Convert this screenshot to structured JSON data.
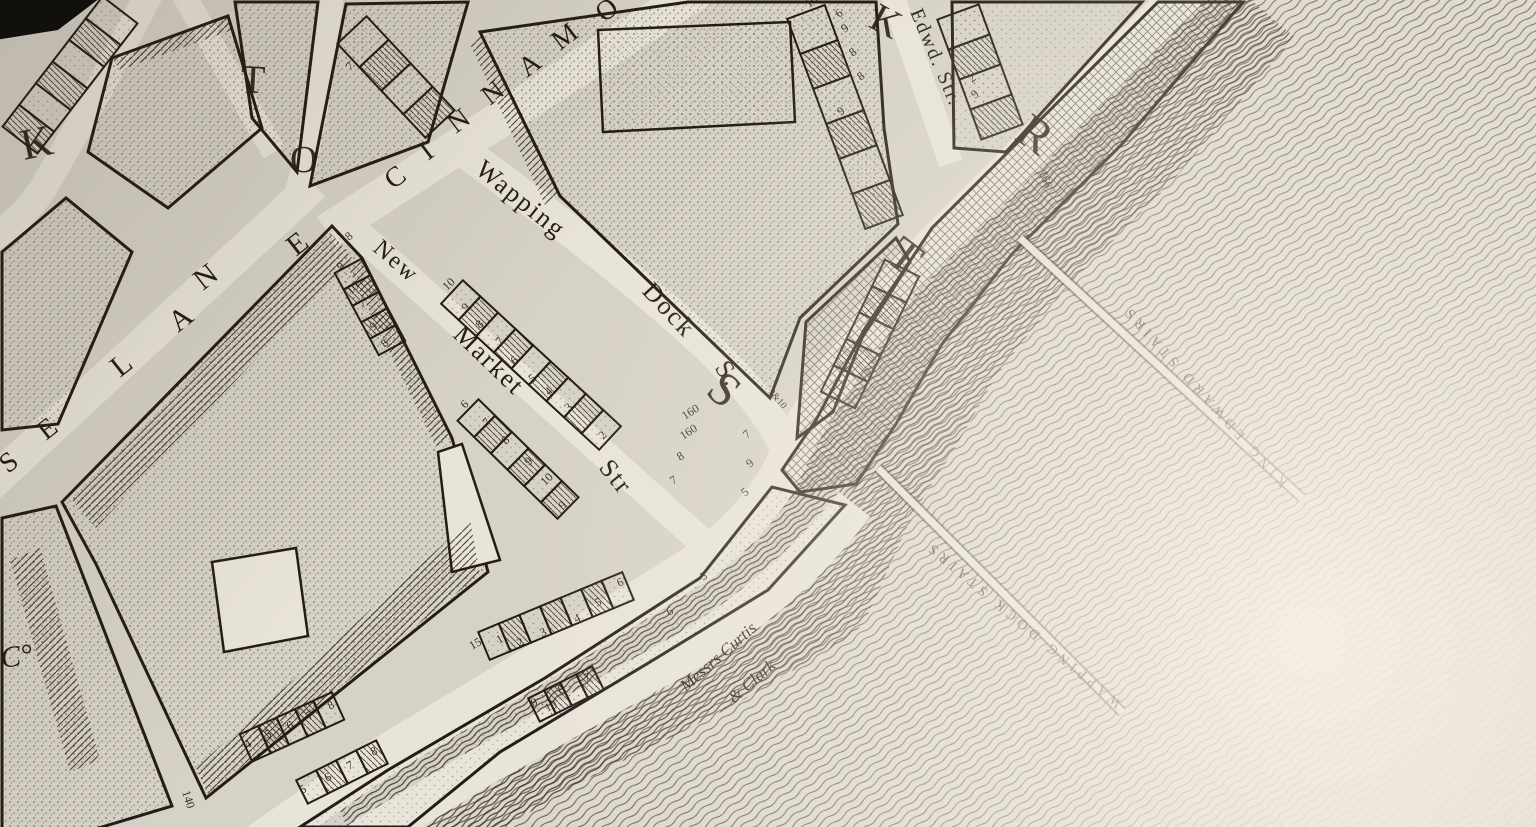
{
  "map_title": "Engraved river-front street map (Wapping, London)",
  "palette": {
    "paper": "#d7d2c8",
    "paper_light": "#e9e4da",
    "ink": "#241d15",
    "water_line": "#3f362c",
    "black_corner": "#12100d",
    "light_corner": "#f4eee5"
  },
  "labels": [
    {
      "name": "cinnamon-street-letter",
      "text": "C",
      "x": 393,
      "y": 190,
      "r": -37,
      "s": 28,
      "cls": "street-name"
    },
    {
      "name": "cinnamon-street-letter",
      "text": "I",
      "x": 428,
      "y": 161,
      "r": -37,
      "s": 28,
      "cls": "street-name"
    },
    {
      "name": "cinnamon-street-letter",
      "text": "N",
      "x": 456,
      "y": 134,
      "r": -37,
      "s": 28,
      "cls": "street-name"
    },
    {
      "name": "cinnamon-street-letter",
      "text": "N",
      "x": 490,
      "y": 106,
      "r": -37,
      "s": 28,
      "cls": "street-name"
    },
    {
      "name": "cinnamon-street-letter",
      "text": "A",
      "x": 527,
      "y": 78,
      "r": -37,
      "s": 28,
      "cls": "street-name"
    },
    {
      "name": "cinnamon-street-letter",
      "text": "M",
      "x": 560,
      "y": 51,
      "r": -37,
      "s": 28,
      "cls": "street-name"
    },
    {
      "name": "cinnamon-street-letter",
      "text": "O",
      "x": 604,
      "y": 23,
      "r": -37,
      "s": 28,
      "cls": "street-name"
    },
    {
      "name": "wapping-dock-street-name",
      "text": "Wapping",
      "x": 474,
      "y": 172,
      "r": 39,
      "s": 26,
      "cls": "street-name"
    },
    {
      "name": "wapping-dock-street-name",
      "text": "Dock",
      "x": 641,
      "y": 292,
      "r": 47,
      "s": 26,
      "cls": "street-name"
    },
    {
      "name": "wapping-dock-street-name",
      "text": "S.",
      "x": 714,
      "y": 368,
      "r": 55,
      "s": 26,
      "cls": "street-name"
    },
    {
      "name": "new-market-street-name",
      "text": "New",
      "x": 372,
      "y": 250,
      "r": 41,
      "s": 24,
      "cls": "street-name"
    },
    {
      "name": "new-market-street-name",
      "text": "Market",
      "x": 452,
      "y": 336,
      "r": 44,
      "s": 26,
      "cls": "street-name"
    },
    {
      "name": "new-market-street-name",
      "text": "Str",
      "x": 598,
      "y": 468,
      "r": 51,
      "s": 26,
      "cls": "street-name"
    },
    {
      "name": "lane-letter",
      "text": "S",
      "x": 8,
      "y": 474,
      "r": -38,
      "s": 28,
      "cls": "street-name"
    },
    {
      "name": "lane-letter",
      "text": "E",
      "x": 46,
      "y": 441,
      "r": -38,
      "s": 28,
      "cls": "street-name"
    },
    {
      "name": "lane-letter",
      "text": "L",
      "x": 120,
      "y": 378,
      "r": -38,
      "s": 30,
      "cls": "street-name"
    },
    {
      "name": "lane-letter",
      "text": "A",
      "x": 178,
      "y": 333,
      "r": -38,
      "s": 30,
      "cls": "street-name"
    },
    {
      "name": "lane-letter",
      "text": "N",
      "x": 203,
      "y": 291,
      "r": -38,
      "s": 30,
      "cls": "street-name"
    },
    {
      "name": "lane-letter",
      "text": "E",
      "x": 296,
      "y": 257,
      "r": -38,
      "s": 30,
      "cls": "street-name"
    },
    {
      "name": "edward-street-name",
      "text": "Edwd. Str.",
      "x": 910,
      "y": 12,
      "r": 67,
      "s": 20,
      "cls": "street-name"
    },
    {
      "name": "big-street-letter",
      "text": "K",
      "x": 24,
      "y": 160,
      "r": -12,
      "s": 44,
      "cls": "big-letter"
    },
    {
      "name": "big-street-letter",
      "text": "T",
      "x": 240,
      "y": 92,
      "r": 3,
      "s": 40,
      "cls": "big-letter"
    },
    {
      "name": "big-street-letter",
      "text": "O",
      "x": 290,
      "y": 172,
      "r": 0,
      "s": 38,
      "cls": "big-letter"
    },
    {
      "name": "big-street-letter",
      "text": "K",
      "x": 867,
      "y": 26,
      "r": 28,
      "s": 40,
      "cls": "big-letter"
    },
    {
      "name": "big-street-letter",
      "text": "S",
      "x": 704,
      "y": 393,
      "r": 40,
      "s": 48,
      "cls": "big-letter"
    },
    {
      "name": "big-street-letter",
      "text": "T",
      "x": 884,
      "y": 260,
      "r": 37,
      "s": 48,
      "cls": "big-letter"
    },
    {
      "name": "big-street-letter",
      "text": "R",
      "x": 1013,
      "y": 138,
      "r": 35,
      "s": 48,
      "cls": "big-letter"
    },
    {
      "name": "king-edward-stairs-label",
      "text": "KING EDWARD STAIRS",
      "x": 1288,
      "y": 482,
      "r": -132,
      "s": 14,
      "cls": "water-name"
    },
    {
      "name": "wapping-dock-stairs-label",
      "text": "WAPPING DOCK STAIRS",
      "x": 1122,
      "y": 702,
      "r": -140,
      "s": 14,
      "cls": "water-name"
    },
    {
      "name": "wharf-owner-label",
      "text": "Messrs Curtis",
      "x": 686,
      "y": 692,
      "r": -41,
      "s": 17,
      "cls": "cursive"
    },
    {
      "name": "wharf-owner-label",
      "text": "& Clark",
      "x": 734,
      "y": 704,
      "r": -41,
      "s": 17,
      "cls": "cursive"
    },
    {
      "name": "company-abbrev-label",
      "text": "C°",
      "x": 2,
      "y": 668,
      "r": -8,
      "s": 30,
      "cls": "cursive"
    },
    {
      "name": "plot-number",
      "text": "10",
      "x": 447,
      "y": 291,
      "r": -44,
      "s": 12,
      "cls": "plot-num"
    },
    {
      "name": "plot-number",
      "text": "9",
      "x": 466,
      "y": 312,
      "r": -44,
      "s": 12,
      "cls": "plot-num"
    },
    {
      "name": "plot-number",
      "text": "8",
      "x": 480,
      "y": 329,
      "r": -44,
      "s": 12,
      "cls": "plot-num"
    },
    {
      "name": "plot-number",
      "text": "7",
      "x": 500,
      "y": 346,
      "r": -44,
      "s": 12,
      "cls": "plot-num"
    },
    {
      "name": "plot-number",
      "text": "6",
      "x": 515,
      "y": 365,
      "r": -44,
      "s": 12,
      "cls": "plot-num"
    },
    {
      "name": "plot-number",
      "text": "5",
      "x": 533,
      "y": 383,
      "r": -44,
      "s": 12,
      "cls": "plot-num"
    },
    {
      "name": "plot-number",
      "text": "4",
      "x": 549,
      "y": 396,
      "r": -44,
      "s": 12,
      "cls": "plot-num"
    },
    {
      "name": "plot-number",
      "text": "3",
      "x": 569,
      "y": 412,
      "r": -44,
      "s": 12,
      "cls": "plot-num"
    },
    {
      "name": "plot-number",
      "text": "2",
      "x": 603,
      "y": 440,
      "r": -44,
      "s": 12,
      "cls": "plot-num"
    },
    {
      "name": "plot-number",
      "text": "6",
      "x": 465,
      "y": 409,
      "r": -44,
      "s": 12,
      "cls": "plot-num"
    },
    {
      "name": "plot-number",
      "text": "7",
      "x": 487,
      "y": 427,
      "r": -44,
      "s": 12,
      "cls": "plot-num"
    },
    {
      "name": "plot-number",
      "text": "8",
      "x": 506,
      "y": 445,
      "r": -44,
      "s": 12,
      "cls": "plot-num"
    },
    {
      "name": "plot-number",
      "text": "9",
      "x": 529,
      "y": 466,
      "r": -44,
      "s": 12,
      "cls": "plot-num"
    },
    {
      "name": "plot-number",
      "text": "10",
      "x": 545,
      "y": 486,
      "r": -44,
      "s": 12,
      "cls": "plot-num"
    },
    {
      "name": "plot-number",
      "text": "9",
      "x": 563,
      "y": 510,
      "r": -44,
      "s": 12,
      "cls": "plot-num"
    },
    {
      "name": "plot-number",
      "text": "9",
      "x": 341,
      "y": 271,
      "r": -44,
      "s": 12,
      "cls": "plot-num"
    },
    {
      "name": "plot-number",
      "text": "10",
      "x": 351,
      "y": 295,
      "r": -44,
      "s": 12,
      "cls": "plot-num"
    },
    {
      "name": "plot-number",
      "text": "7",
      "x": 363,
      "y": 309,
      "r": -44,
      "s": 12,
      "cls": "plot-num"
    },
    {
      "name": "plot-number",
      "text": "9",
      "x": 374,
      "y": 331,
      "r": -44,
      "s": 12,
      "cls": "plot-num"
    },
    {
      "name": "plot-number",
      "text": "8",
      "x": 385,
      "y": 348,
      "r": -44,
      "s": 12,
      "cls": "plot-num"
    },
    {
      "name": "plot-number",
      "text": "15",
      "x": 472,
      "y": 650,
      "r": -30,
      "s": 12,
      "cls": "plot-num"
    },
    {
      "name": "plot-number",
      "text": "1",
      "x": 499,
      "y": 644,
      "r": -30,
      "s": 12,
      "cls": "plot-num"
    },
    {
      "name": "plot-number",
      "text": "2",
      "x": 519,
      "y": 647,
      "r": -25,
      "s": 12,
      "cls": "plot-num"
    },
    {
      "name": "plot-number",
      "text": "3",
      "x": 542,
      "y": 637,
      "r": -25,
      "s": 12,
      "cls": "plot-num"
    },
    {
      "name": "plot-number",
      "text": "4",
      "x": 576,
      "y": 623,
      "r": -25,
      "s": 12,
      "cls": "plot-num"
    },
    {
      "name": "plot-number",
      "text": "5",
      "x": 597,
      "y": 607,
      "r": -25,
      "s": 12,
      "cls": "plot-num"
    },
    {
      "name": "plot-number",
      "text": "6",
      "x": 619,
      "y": 587,
      "r": -25,
      "s": 12,
      "cls": "plot-num"
    },
    {
      "name": "plot-number",
      "text": "6",
      "x": 669,
      "y": 616,
      "r": -30,
      "s": 12,
      "cls": "plot-num"
    },
    {
      "name": "plot-number",
      "text": "5",
      "x": 703,
      "y": 581,
      "r": -30,
      "s": 12,
      "cls": "plot-num"
    },
    {
      "name": "plot-number",
      "text": "9",
      "x": 533,
      "y": 707,
      "r": -25,
      "s": 12,
      "cls": "plot-num"
    },
    {
      "name": "plot-number",
      "text": "10",
      "x": 547,
      "y": 712,
      "r": -25,
      "s": 12,
      "cls": "plot-num"
    },
    {
      "name": "plot-number",
      "text": "8",
      "x": 560,
      "y": 694,
      "r": -25,
      "s": 12,
      "cls": "plot-num"
    },
    {
      "name": "plot-number",
      "text": "7",
      "x": 586,
      "y": 682,
      "r": -25,
      "s": 12,
      "cls": "plot-num"
    },
    {
      "name": "plot-number",
      "text": "4",
      "x": 247,
      "y": 749,
      "r": -28,
      "s": 12,
      "cls": "plot-num"
    },
    {
      "name": "plot-number",
      "text": "5",
      "x": 267,
      "y": 739,
      "r": -28,
      "s": 12,
      "cls": "plot-num"
    },
    {
      "name": "plot-number",
      "text": "6",
      "x": 289,
      "y": 730,
      "r": -28,
      "s": 12,
      "cls": "plot-num"
    },
    {
      "name": "plot-number",
      "text": "7",
      "x": 309,
      "y": 720,
      "r": -28,
      "s": 12,
      "cls": "plot-num"
    },
    {
      "name": "plot-number",
      "text": "8",
      "x": 330,
      "y": 710,
      "r": -28,
      "s": 12,
      "cls": "plot-num"
    },
    {
      "name": "plot-number",
      "text": "5",
      "x": 302,
      "y": 794,
      "r": -28,
      "s": 12,
      "cls": "plot-num"
    },
    {
      "name": "plot-number",
      "text": "6",
      "x": 327,
      "y": 782,
      "r": -28,
      "s": 12,
      "cls": "plot-num"
    },
    {
      "name": "plot-number",
      "text": "7",
      "x": 349,
      "y": 770,
      "r": -28,
      "s": 12,
      "cls": "plot-num"
    },
    {
      "name": "plot-number",
      "text": "8",
      "x": 373,
      "y": 756,
      "r": -28,
      "s": 12,
      "cls": "plot-num"
    },
    {
      "name": "plot-number",
      "text": "140",
      "x": 182,
      "y": 792,
      "r": 72,
      "s": 12,
      "cls": "plot-num"
    },
    {
      "name": "plot-number",
      "text": "160",
      "x": 685,
      "y": 420,
      "r": -33,
      "s": 12,
      "cls": "plot-num"
    },
    {
      "name": "plot-number",
      "text": "160",
      "x": 683,
      "y": 440,
      "r": -33,
      "s": 12,
      "cls": "plot-num"
    },
    {
      "name": "plot-number",
      "text": "8",
      "x": 680,
      "y": 461,
      "r": -33,
      "s": 12,
      "cls": "plot-num"
    },
    {
      "name": "plot-number",
      "text": "7",
      "x": 673,
      "y": 485,
      "r": -33,
      "s": 12,
      "cls": "plot-num"
    },
    {
      "name": "plot-number",
      "text": "7",
      "x": 747,
      "y": 439,
      "r": -40,
      "s": 12,
      "cls": "plot-num"
    },
    {
      "name": "plot-number",
      "text": "9",
      "x": 750,
      "y": 468,
      "r": -40,
      "s": 12,
      "cls": "plot-num"
    },
    {
      "name": "plot-number",
      "text": "5",
      "x": 745,
      "y": 497,
      "r": -40,
      "s": 12,
      "cls": "plot-num"
    },
    {
      "name": "plot-number",
      "text": "9&10",
      "x": 768,
      "y": 392,
      "r": 50,
      "s": 10,
      "cls": "plot-num"
    },
    {
      "name": "plot-number",
      "text": "166",
      "x": 1039,
      "y": 172,
      "r": 70,
      "s": 12,
      "cls": "plot-num"
    },
    {
      "name": "plot-number",
      "text": "10",
      "x": 809,
      "y": 8,
      "r": -40,
      "s": 12,
      "cls": "plot-num"
    },
    {
      "name": "plot-number",
      "text": "6",
      "x": 839,
      "y": 18,
      "r": -40,
      "s": 12,
      "cls": "plot-num"
    },
    {
      "name": "plot-number",
      "text": "9",
      "x": 845,
      "y": 33,
      "r": -40,
      "s": 12,
      "cls": "plot-num"
    },
    {
      "name": "plot-number",
      "text": "8",
      "x": 853,
      "y": 57,
      "r": -40,
      "s": 12,
      "cls": "plot-num"
    },
    {
      "name": "plot-number",
      "text": "8",
      "x": 861,
      "y": 81,
      "r": -40,
      "s": 12,
      "cls": "plot-num"
    },
    {
      "name": "plot-number",
      "text": "2",
      "x": 972,
      "y": 83,
      "r": -40,
      "s": 12,
      "cls": "plot-num"
    },
    {
      "name": "plot-number",
      "text": "9",
      "x": 975,
      "y": 99,
      "r": -40,
      "s": 12,
      "cls": "plot-num"
    },
    {
      "name": "plot-number",
      "text": "8",
      "x": 349,
      "y": 241,
      "r": -40,
      "s": 12,
      "cls": "plot-num"
    },
    {
      "name": "plot-number",
      "text": "7",
      "x": 350,
      "y": 71,
      "r": -40,
      "s": 12,
      "cls": "plot-num"
    },
    {
      "name": "plot-number",
      "text": "9",
      "x": 841,
      "y": 116,
      "r": -40,
      "s": 12,
      "cls": "plot-num"
    }
  ]
}
